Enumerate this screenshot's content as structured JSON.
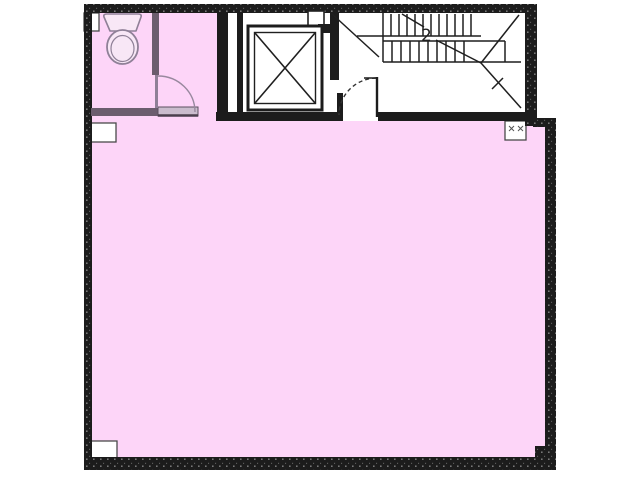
{
  "canvas": {
    "width": 640,
    "height": 480
  },
  "colors": {
    "background": "#ffffff",
    "floor_pink": "#fdd5f8",
    "wall_black": "#1c1c1c",
    "line_black": "#1f1f1f",
    "partition_gray": "#6b5d6e",
    "door_panel_gray": "#cabccd",
    "fixture_gray": "#8f8097",
    "notch_stroke": "#4a4a4a"
  },
  "stairs": {
    "label": "2"
  },
  "floorplan": {
    "rooms": [
      {
        "name": "wc"
      },
      {
        "name": "hallway"
      },
      {
        "name": "elevator-shaft"
      },
      {
        "name": "stairwell"
      },
      {
        "name": "main-room"
      },
      {
        "name": "pipe-space"
      }
    ],
    "fixtures": [
      {
        "name": "toilet"
      },
      {
        "name": "elevator-x"
      },
      {
        "name": "staircase-treads"
      },
      {
        "name": "wc-door-swing"
      },
      {
        "name": "stairwell-door-swing"
      }
    ]
  }
}
